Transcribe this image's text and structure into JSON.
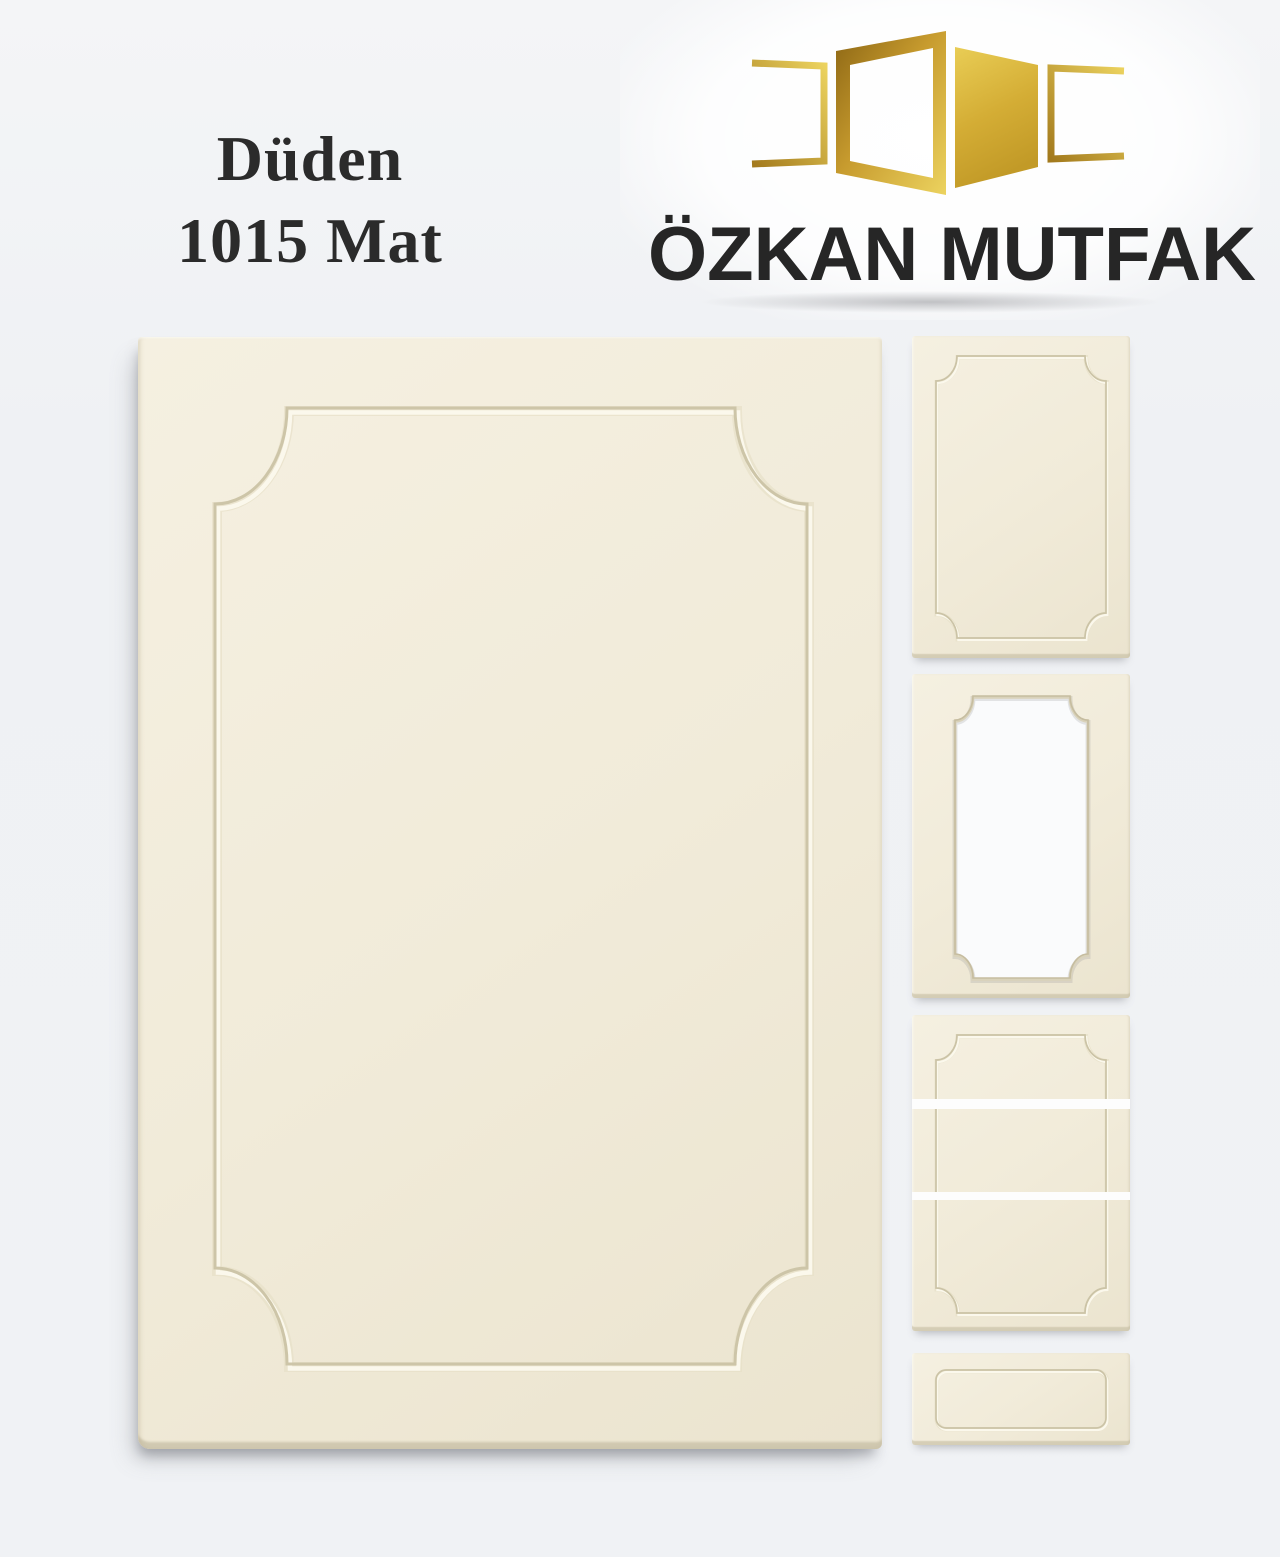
{
  "page": {
    "background": "#eff1f4"
  },
  "title": {
    "line1": "Düden",
    "line2": "1015 Mat",
    "color": "#2b2b2b"
  },
  "brand": {
    "name": "ÖZKAN MUTFAK",
    "text_color": "#262626",
    "logo_icon": "golden-open-doors-icon",
    "gold_dark": "#8c6614",
    "gold_mid": "#c79b2e",
    "gold_light": "#ecd35f"
  },
  "product": {
    "door_finish": "Mat",
    "face_color": "#f1ebd9",
    "groove_shadow_color": "#cdc5a8",
    "groove_highlight_color": "#fbf8ec",
    "style": "routed frame with scooped corners"
  },
  "gallery": {
    "main_preview": "full-door-large",
    "thumbnails": [
      {
        "type": "full-door"
      },
      {
        "type": "glass-frame-door"
      },
      {
        "type": "tall-door-three-segments"
      },
      {
        "type": "drawer-front"
      }
    ]
  }
}
